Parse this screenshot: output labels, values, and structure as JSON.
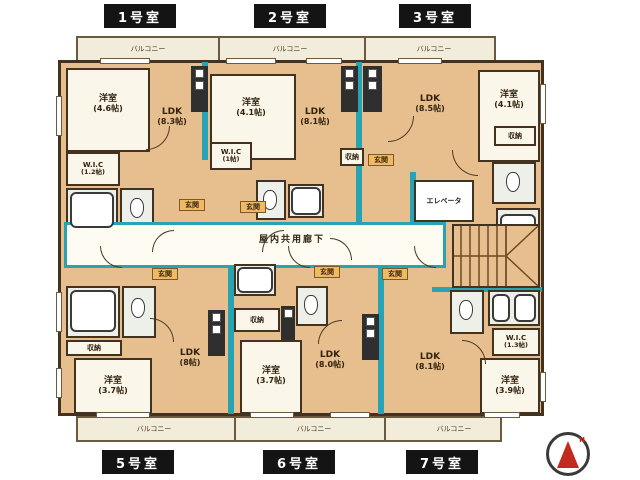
{
  "colors": {
    "plan_fill": "#e7bf8e",
    "wall": "#43321f",
    "accent_teal": "#27a3b4",
    "room_fill": "#faf6ea",
    "balcony_fill": "#f2edda",
    "tag_bg": "#141414",
    "tag_text": "#ffffff",
    "entrance_fill": "#f0b964",
    "compass_red": "#c22a1e"
  },
  "top_unit_labels": [
    {
      "label": "1号室"
    },
    {
      "label": "2号室"
    },
    {
      "label": "3号室"
    }
  ],
  "bottom_unit_labels": [
    {
      "label": "5号室"
    },
    {
      "label": "6号室"
    },
    {
      "label": "7号室"
    }
  ],
  "balcony_label": "バルコニー",
  "corridor_label": "屋内共用廊下",
  "elevator_label": "エレベータ",
  "entrance_label": "玄関",
  "storage_label": "収納",
  "compass_letter": "N",
  "units": {
    "u1": {
      "bedroom": "洋室",
      "bedroom_size": "(4.6帖)",
      "ldk": "LDK",
      "ldk_size": "(8.3帖)",
      "wic": "W.I.C",
      "wic_size": "(1.2帖)"
    },
    "u2": {
      "bedroom": "洋室",
      "bedroom_size": "(4.1帖)",
      "ldk": "LDK",
      "ldk_size": "(8.1帖)",
      "wic": "W.I.C",
      "wic_size": "(1帖)"
    },
    "u3": {
      "bedroom": "洋室",
      "bedroom_size": "(4.1帖)",
      "ldk": "LDK",
      "ldk_size": "(8.5帖)"
    },
    "u5": {
      "bedroom": "洋室",
      "bedroom_size": "(3.7帖)",
      "ldk": "LDK",
      "ldk_size": "(8帖)"
    },
    "u6": {
      "bedroom": "洋室",
      "bedroom_size": "(3.7帖)",
      "ldk": "LDK",
      "ldk_size": "(8.0帖)"
    },
    "u7": {
      "bedroom": "洋室",
      "bedroom_size": "(3.9帖)",
      "ldk": "LDK",
      "ldk_size": "(8.1帖)",
      "wic": "W.I.C",
      "wic_size": "(1.3帖)"
    }
  }
}
